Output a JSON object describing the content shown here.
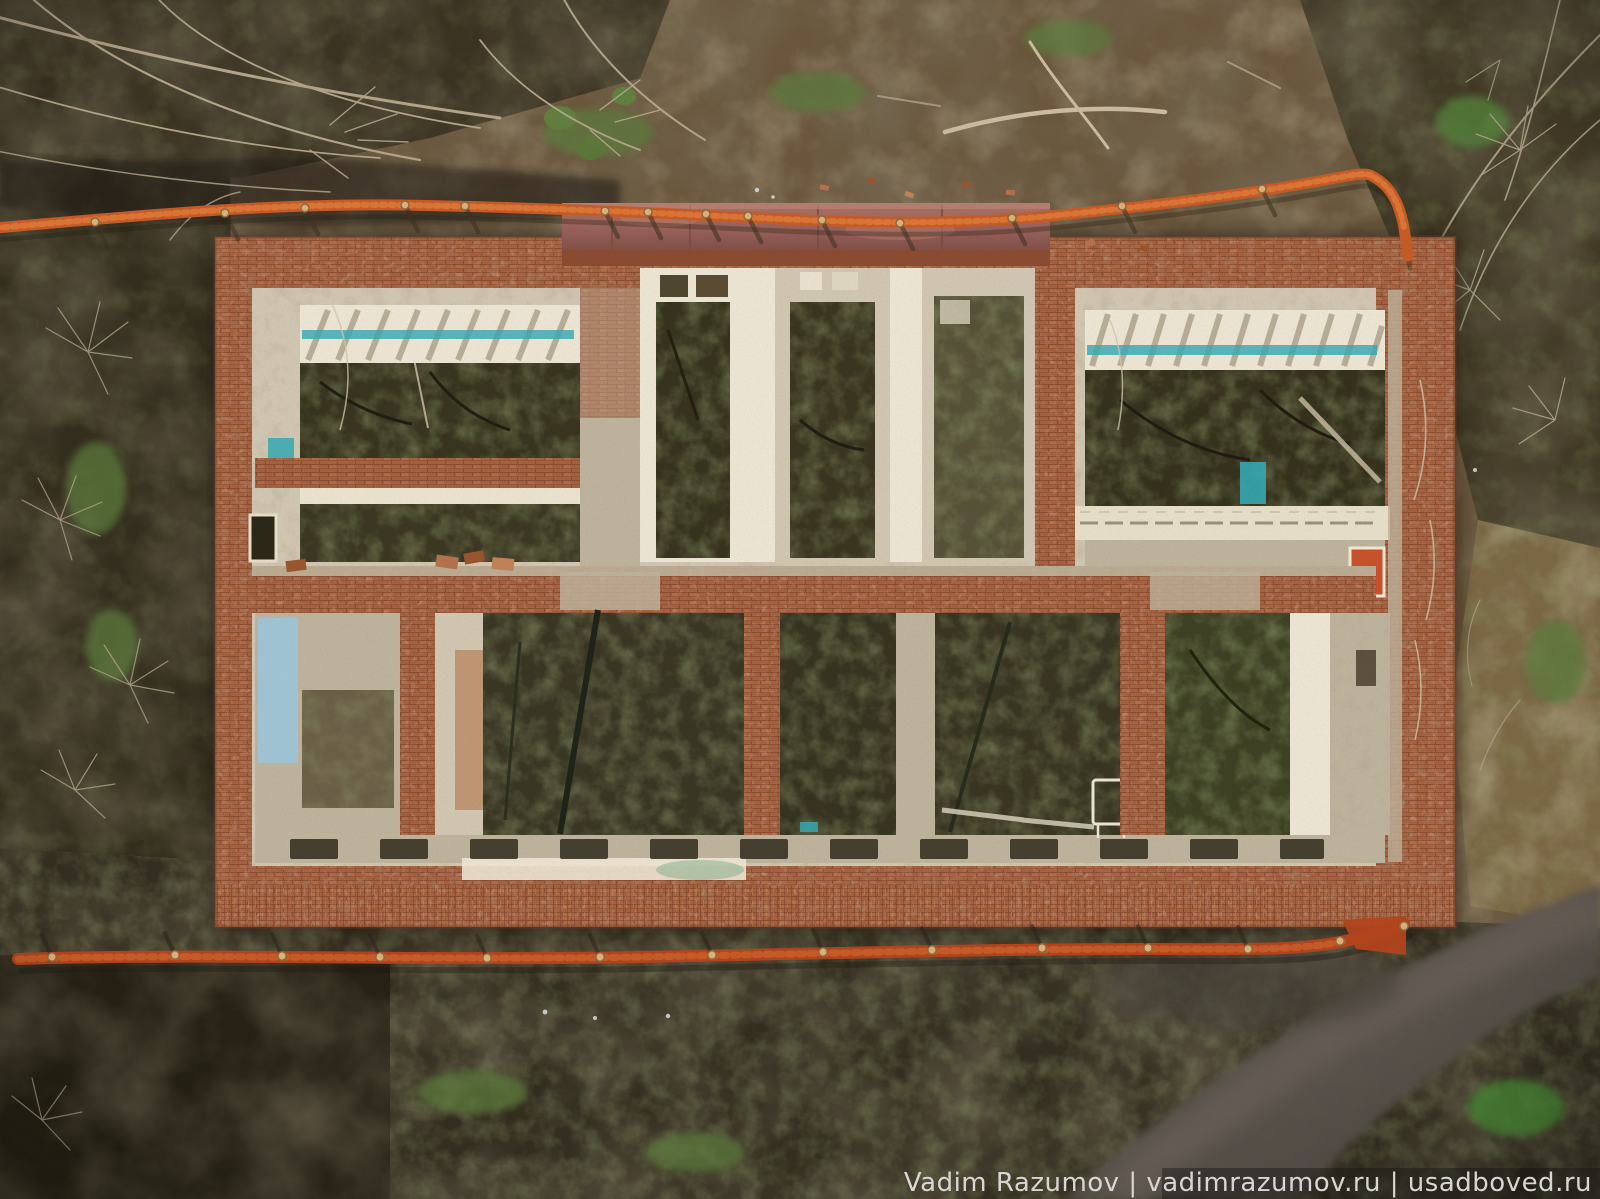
{
  "scene": {
    "description": "Aerial top-down drone photograph of a ruined roofless brick manor house with exposed room walls, surrounded by orange construction mesh fencing, bare winter woodland and muddy ground",
    "watermark": {
      "text": "Vadim Razumov | vadimrazumov.ru | usadboved.ru"
    },
    "colors": {
      "ground_base": "#6a573d",
      "ground_light": "#8a7452",
      "woodland_dark": "#3b3322",
      "woodland_left": "#342e1e",
      "right_strip_tan": "#7a6845",
      "humus_dark": "#342e20",
      "humus_corner": "#262114",
      "path_gray": "#5a524d",
      "path_light": "#6e655c",
      "branch_pale": "#b2a489",
      "branch_light": "#cabba0",
      "grass_green": "#5d7a3c",
      "bright_green": "#4e9a38",
      "fence_top_orange": "#c65b27",
      "fence_mesh_light": "#e07e3c",
      "fence_bottom_red": "#b2441d",
      "fence_post_tan": "#dcb077",
      "brick_main": "#a5613e",
      "brick_dark": "#8a4c30",
      "brick_light": "#c08258",
      "plaster_cream": "#cfc5b0",
      "plaster_bright": "#ece4d2",
      "plaster_dim": "#bdb29b",
      "room_debris_dark": "#38341f",
      "room_moss": "#49502c",
      "teal_paint": "#35a8b2",
      "sky_blue_paint": "#9ec4d6",
      "portico_mauve": "#996159",
      "portico_dark": "#7c4b44",
      "red_door": "#c8512d",
      "watermark_text": "#d8d6d3",
      "watermark_band": "#141414"
    },
    "fence": {
      "top_post_count": 14,
      "bottom_post_count": 14
    },
    "building": {
      "top_row_rooms": 5,
      "bottom_row_rooms": 6,
      "stories_visible": 1,
      "roof": "collapsed"
    }
  }
}
